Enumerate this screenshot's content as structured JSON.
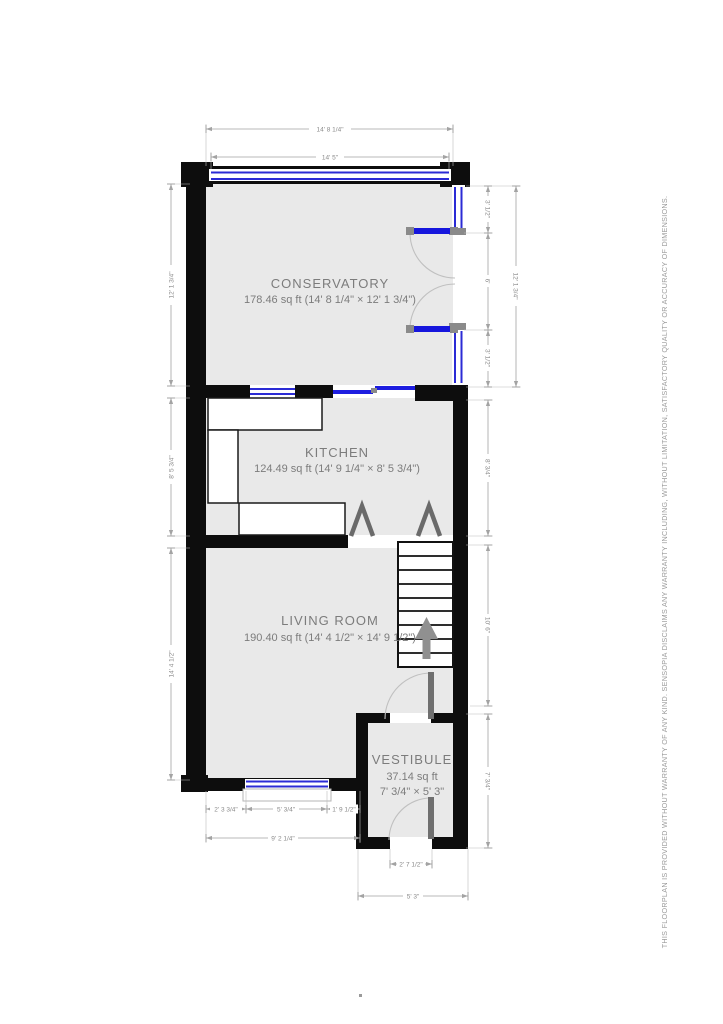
{
  "disclaimer": "THIS FLOORPLAN IS PROVIDED WITHOUT WARRANTY OF ANY KIND. SENSOPIA DISCLAIMS ANY WARRANTY INCLUDING, WITHOUT LIMITATION, SATISFACTORY QUALITY OR ACCURACY OF DIMENSIONS.",
  "rooms": {
    "conservatory": {
      "name": "CONSERVATORY",
      "area": "178.46 sq ft (14' 8 1/4\" × 12' 1 3/4\")"
    },
    "kitchen": {
      "name": "KITCHEN",
      "area": "124.49 sq ft (14' 9 1/4\" × 8' 5 3/4\")"
    },
    "living_room": {
      "name": "LIVING ROOM",
      "area": "190.40 sq ft (14' 4 1/2\" × 14' 9 1/2\")"
    },
    "vestibule": {
      "name": "VESTIBULE",
      "area": "37.14 sq ft",
      "size": "7' 3/4\" × 5' 3\""
    }
  },
  "dimensions": {
    "top_overall": "14' 8 1/4\"",
    "top_window": "14' 5\"",
    "conservatory_left": "12' 1 3/4\"",
    "conservatory_right_overall": "12' 1 3/4\"",
    "conservatory_right_upper": "3' 1/2\"",
    "conservatory_right_door": "6'",
    "conservatory_right_lower": "3' 1/2\"",
    "kitchen_left": "8' 5 3/4\"",
    "kitchen_right": "8' 3/4\"",
    "living_left": "14' 4 1/2\"",
    "stairs_right": "10' 6\"",
    "vestibule_right": "7' 3/4\"",
    "bottom_left_seg": "2' 3 3/4\"",
    "bottom_window_seg": "5' 3/4\"",
    "bottom_right_seg": "1' 9 1/2\"",
    "bottom_overall": "9' 2 1/4\"",
    "front_door_width": "2' 7 1/2\"",
    "vestibule_width": "5' 3\""
  },
  "colors": {
    "wall": "#0d0d0d",
    "room_fill": "#e9e9e9",
    "window_blue": "#2b2bd5",
    "door_blue": "#1616dd",
    "dimension_gray": "#8a8a8a",
    "label_gray": "#7c7c7c"
  }
}
